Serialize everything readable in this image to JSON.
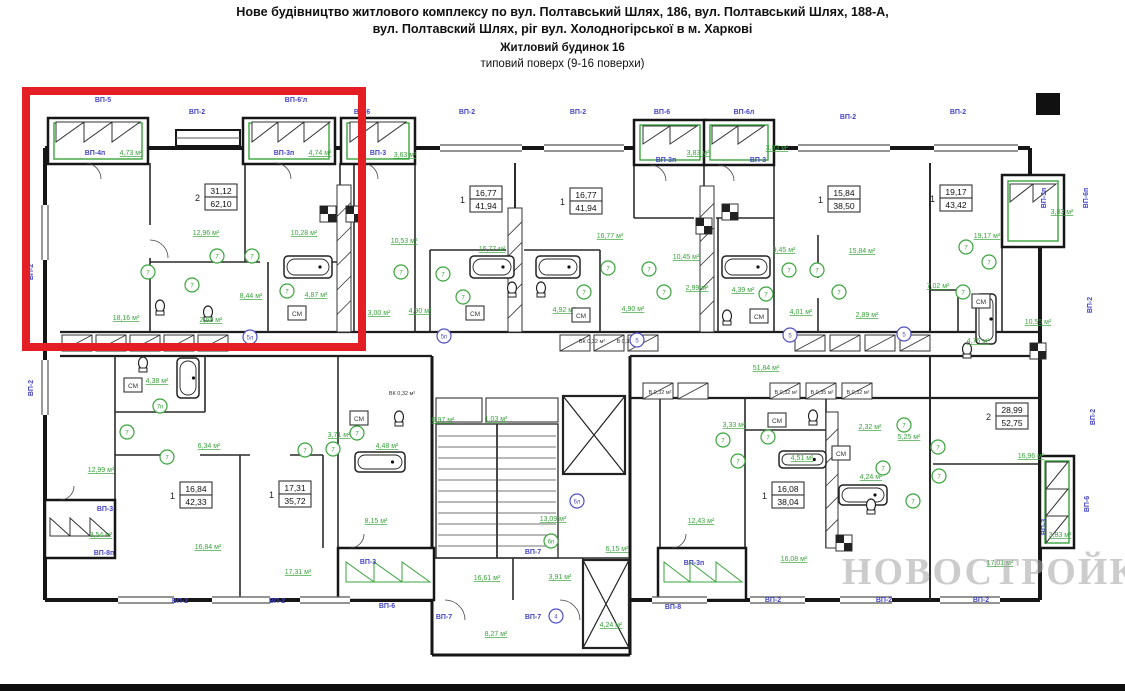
{
  "title": {
    "line1": "Нове будівництво житлового комплексу по вул. Полтавський Шлях, 186, вул. Полтавський Шлях, 188-А,",
    "line2": "вул. Полтавский Шлях, ріг вул. Холодногірської в м. Харкові",
    "line3": "Житловий будинок 16",
    "line4": "типовий поверх (9-16 поверхи)"
  },
  "watermark": "НОВОСТРОЙКИ",
  "colors": {
    "wall": "#161616",
    "green": "#3aa43c",
    "blue": "#4545c5",
    "purple": "#5050c0",
    "red": "#e31e24",
    "watermark": "#aaaaaa"
  },
  "plan": {
    "apartments": [
      {
        "num": "2",
        "upper": "31,12",
        "lower": "62,10",
        "x": 205,
        "y": 184
      },
      {
        "num": "1",
        "upper": "16,77",
        "lower": "41,94",
        "x": 470,
        "y": 186
      },
      {
        "num": "1",
        "upper": "16,77",
        "lower": "41,94",
        "x": 570,
        "y": 188
      },
      {
        "num": "1",
        "upper": "15,84",
        "lower": "38,50",
        "x": 828,
        "y": 186
      },
      {
        "num": "1",
        "upper": "19,17",
        "lower": "43,42",
        "x": 940,
        "y": 185
      },
      {
        "num": "1",
        "upper": "16,84",
        "lower": "42,33",
        "x": 180,
        "y": 482
      },
      {
        "num": "1",
        "upper": "17,31",
        "lower": "35,72",
        "x": 279,
        "y": 481
      },
      {
        "num": "1",
        "upper": "16,08",
        "lower": "38,04",
        "x": 772,
        "y": 482
      },
      {
        "num": "2",
        "upper": "28,99",
        "lower": "52,75",
        "x": 996,
        "y": 403
      }
    ],
    "vp_labels": [
      {
        "t": "ВП-5",
        "x": 103,
        "y": 102
      },
      {
        "t": "ВП-2",
        "x": 197,
        "y": 114
      },
      {
        "t": "ВП-6'л",
        "x": 296,
        "y": 102
      },
      {
        "t": "ВП-6",
        "x": 362,
        "y": 114
      },
      {
        "t": "ВП-2",
        "x": 467,
        "y": 114
      },
      {
        "t": "ВП-2",
        "x": 578,
        "y": 114
      },
      {
        "t": "ВП-6",
        "x": 662,
        "y": 114
      },
      {
        "t": "ВП-6л",
        "x": 744,
        "y": 114
      },
      {
        "t": "ВП-2",
        "x": 848,
        "y": 119
      },
      {
        "t": "ВП-2",
        "x": 958,
        "y": 114
      },
      {
        "t": "ВП-4п",
        "x": 95,
        "y": 155
      },
      {
        "t": "ВП-3п",
        "x": 284,
        "y": 155
      },
      {
        "t": "ВП-3",
        "x": 378,
        "y": 155
      },
      {
        "t": "ВП-3п",
        "x": 666,
        "y": 162
      },
      {
        "t": "ВП-3",
        "x": 758,
        "y": 162
      },
      {
        "t": "ВП-2",
        "x": 33,
        "y": 272,
        "rot": -90
      },
      {
        "t": "ВП-2",
        "x": 33,
        "y": 388,
        "rot": -90
      },
      {
        "t": "ВП-3п",
        "x": 1046,
        "y": 198,
        "rot": -90
      },
      {
        "t": "ВП-6п",
        "x": 1088,
        "y": 198,
        "rot": -90
      },
      {
        "t": "ВП-2",
        "x": 1092,
        "y": 305,
        "rot": -90
      },
      {
        "t": "ВП-2",
        "x": 1095,
        "y": 417,
        "rot": -90
      },
      {
        "t": "ВП-3",
        "x": 1046,
        "y": 527,
        "rot": -90
      },
      {
        "t": "ВП-6",
        "x": 1089,
        "y": 504,
        "rot": -90
      },
      {
        "t": "ВП-3",
        "x": 105,
        "y": 511
      },
      {
        "t": "ВП-8п",
        "x": 104,
        "y": 555
      },
      {
        "t": "ВП-2",
        "x": 180,
        "y": 603
      },
      {
        "t": "ВП-2",
        "x": 277,
        "y": 603
      },
      {
        "t": "ВП-3",
        "x": 368,
        "y": 564
      },
      {
        "t": "ВП-6",
        "x": 387,
        "y": 608
      },
      {
        "t": "ВП-7",
        "x": 533,
        "y": 554
      },
      {
        "t": "ВП-7",
        "x": 444,
        "y": 619
      },
      {
        "t": "ВП-7",
        "x": 533,
        "y": 619
      },
      {
        "t": "ВП-3п",
        "x": 694,
        "y": 565
      },
      {
        "t": "ВП-8",
        "x": 673,
        "y": 609
      },
      {
        "t": "ВП-2",
        "x": 773,
        "y": 602
      },
      {
        "t": "ВП-2",
        "x": 884,
        "y": 602
      },
      {
        "t": "ВП-2",
        "x": 981,
        "y": 602
      }
    ],
    "area_labels": [
      {
        "t": "4,73 м²",
        "x": 131,
        "y": 155
      },
      {
        "t": "4,74 м²",
        "x": 320,
        "y": 155
      },
      {
        "t": "3,63 м²",
        "x": 405,
        "y": 157
      },
      {
        "t": "3,83 м²",
        "x": 698,
        "y": 155
      },
      {
        "t": "3,83 м²",
        "x": 777,
        "y": 150
      },
      {
        "t": "3,83 м²",
        "x": 1062,
        "y": 214
      },
      {
        "t": "12,96 м²",
        "x": 206,
        "y": 235
      },
      {
        "t": "10,28 м²",
        "x": 304,
        "y": 235
      },
      {
        "t": "8,44 м²",
        "x": 251,
        "y": 298
      },
      {
        "t": "4,87 м²",
        "x": 316,
        "y": 297
      },
      {
        "t": "18,16 м²",
        "x": 126,
        "y": 320
      },
      {
        "t": "2,65 м²",
        "x": 211,
        "y": 322
      },
      {
        "t": "10,53 м²",
        "x": 404,
        "y": 243
      },
      {
        "t": "16,77 м²",
        "x": 492,
        "y": 251
      },
      {
        "t": "16,77 м²",
        "x": 610,
        "y": 238
      },
      {
        "t": "3,00 м²",
        "x": 379,
        "y": 315
      },
      {
        "t": "4,90 м²",
        "x": 420,
        "y": 313
      },
      {
        "t": "4,92 м²",
        "x": 564,
        "y": 312
      },
      {
        "t": "4,90 м²",
        "x": 633,
        "y": 311
      },
      {
        "t": "10,45 м²",
        "x": 686,
        "y": 259
      },
      {
        "t": "9,45 м²",
        "x": 784,
        "y": 252
      },
      {
        "t": "15,84 м²",
        "x": 862,
        "y": 253
      },
      {
        "t": "2,99 м²",
        "x": 697,
        "y": 290
      },
      {
        "t": "4,39 м²",
        "x": 743,
        "y": 292
      },
      {
        "t": "4,01 м²",
        "x": 801,
        "y": 314
      },
      {
        "t": "2,89 м²",
        "x": 867,
        "y": 317
      },
      {
        "t": "19,17 м²",
        "x": 987,
        "y": 238
      },
      {
        "t": "7,02 м²",
        "x": 938,
        "y": 288
      },
      {
        "t": "10,55 м²",
        "x": 1038,
        "y": 324
      },
      {
        "t": "4,76 м²",
        "x": 978,
        "y": 343
      },
      {
        "t": "51,84 м²",
        "x": 766,
        "y": 370
      },
      {
        "t": "4,38 м²",
        "x": 157,
        "y": 383
      },
      {
        "t": "12,99 м²",
        "x": 101,
        "y": 472
      },
      {
        "t": "3,54 м²",
        "x": 101,
        "y": 537
      },
      {
        "t": "6,34 м²",
        "x": 209,
        "y": 448
      },
      {
        "t": "16,84 м²",
        "x": 208,
        "y": 549
      },
      {
        "t": "17,31 м²",
        "x": 298,
        "y": 574
      },
      {
        "t": "3,71 м²",
        "x": 339,
        "y": 437
      },
      {
        "t": "4,48 м²",
        "x": 387,
        "y": 448
      },
      {
        "t": "8,15 м²",
        "x": 376,
        "y": 523
      },
      {
        "t": "0,97 м²",
        "x": 443,
        "y": 422
      },
      {
        "t": "1,03 м²",
        "x": 496,
        "y": 421
      },
      {
        "t": "16,61 м²",
        "x": 487,
        "y": 580
      },
      {
        "t": "3,91 м²",
        "x": 560,
        "y": 579
      },
      {
        "t": "13,09 м²",
        "x": 553,
        "y": 521
      },
      {
        "t": "6,15 м²",
        "x": 617,
        "y": 551
      },
      {
        "t": "8,27 м²",
        "x": 496,
        "y": 636
      },
      {
        "t": "4,24 м²",
        "x": 611,
        "y": 627
      },
      {
        "t": "12,43 м²",
        "x": 701,
        "y": 523
      },
      {
        "t": "16,08 м²",
        "x": 794,
        "y": 561
      },
      {
        "t": "3,33 м²",
        "x": 734,
        "y": 427
      },
      {
        "t": "2,32 м²",
        "x": 870,
        "y": 429
      },
      {
        "t": "4,51 м²",
        "x": 802,
        "y": 460
      },
      {
        "t": "4,24 м²",
        "x": 871,
        "y": 479
      },
      {
        "t": "5,25 м²",
        "x": 909,
        "y": 439
      },
      {
        "t": "16,96 м²",
        "x": 1031,
        "y": 458
      },
      {
        "t": "17,01 м²",
        "x": 1000,
        "y": 565
      },
      {
        "t": "3,83 м²",
        "x": 1060,
        "y": 537
      }
    ],
    "cm_label": "СМ",
    "cm_boxes": [
      {
        "x": 288,
        "y": 306
      },
      {
        "x": 466,
        "y": 306
      },
      {
        "x": 572,
        "y": 308
      },
      {
        "x": 750,
        "y": 309
      },
      {
        "x": 972,
        "y": 294
      },
      {
        "x": 124,
        "y": 378
      },
      {
        "x": 350,
        "y": 411
      },
      {
        "x": 768,
        "y": 413
      },
      {
        "x": 832,
        "y": 446
      }
    ],
    "duct_labels": [
      {
        "t": "ВК 0,32 м²",
        "x": 402,
        "y": 395
      },
      {
        "t": "ВК 0,32 м²",
        "x": 592,
        "y": 343
      },
      {
        "t": "В 0,32 м²",
        "x": 628,
        "y": 343
      },
      {
        "t": "В 0,32 м²",
        "x": 660,
        "y": 394
      },
      {
        "t": "В 0,32 м²",
        "x": 786,
        "y": 394
      },
      {
        "t": "В 0,35 м²",
        "x": 822,
        "y": 394
      },
      {
        "t": "В 0,32 м²",
        "x": 858,
        "y": 394
      }
    ],
    "markers_green": [
      {
        "t": "7",
        "x": 217,
        "y": 256
      },
      {
        "t": "7",
        "x": 252,
        "y": 256
      },
      {
        "t": "7",
        "x": 148,
        "y": 272
      },
      {
        "t": "7",
        "x": 192,
        "y": 285
      },
      {
        "t": "7",
        "x": 287,
        "y": 291
      },
      {
        "t": "7",
        "x": 401,
        "y": 272
      },
      {
        "t": "7",
        "x": 443,
        "y": 274
      },
      {
        "t": "7",
        "x": 463,
        "y": 297
      },
      {
        "t": "7",
        "x": 584,
        "y": 292
      },
      {
        "t": "7",
        "x": 608,
        "y": 268
      },
      {
        "t": "7",
        "x": 649,
        "y": 269
      },
      {
        "t": "7",
        "x": 664,
        "y": 292
      },
      {
        "t": "7",
        "x": 766,
        "y": 294
      },
      {
        "t": "7",
        "x": 789,
        "y": 270
      },
      {
        "t": "7",
        "x": 817,
        "y": 270
      },
      {
        "t": "7",
        "x": 839,
        "y": 292
      },
      {
        "t": "7",
        "x": 966,
        "y": 247
      },
      {
        "t": "7",
        "x": 989,
        "y": 262
      },
      {
        "t": "7",
        "x": 963,
        "y": 292
      },
      {
        "t": "7",
        "x": 127,
        "y": 432
      },
      {
        "t": "7п",
        "x": 160,
        "y": 406
      },
      {
        "t": "7",
        "x": 167,
        "y": 457
      },
      {
        "t": "7",
        "x": 305,
        "y": 450
      },
      {
        "t": "7",
        "x": 333,
        "y": 449
      },
      {
        "t": "7",
        "x": 357,
        "y": 433
      },
      {
        "t": "7",
        "x": 723,
        "y": 440
      },
      {
        "t": "7",
        "x": 768,
        "y": 437
      },
      {
        "t": "7",
        "x": 738,
        "y": 461
      },
      {
        "t": "7",
        "x": 883,
        "y": 468
      },
      {
        "t": "7",
        "x": 904,
        "y": 425
      },
      {
        "t": "7",
        "x": 938,
        "y": 447
      },
      {
        "t": "7",
        "x": 939,
        "y": 476
      },
      {
        "t": "7",
        "x": 913,
        "y": 501
      },
      {
        "t": "6п",
        "x": 551,
        "y": 541
      }
    ],
    "markers_purple": [
      {
        "t": "5л",
        "x": 250,
        "y": 337
      },
      {
        "t": "5п",
        "x": 444,
        "y": 336
      },
      {
        "t": "5",
        "x": 637,
        "y": 340
      },
      {
        "t": "5",
        "x": 790,
        "y": 335
      },
      {
        "t": "5",
        "x": 904,
        "y": 334
      },
      {
        "t": "4",
        "x": 556,
        "y": 616
      },
      {
        "t": "6л",
        "x": 577,
        "y": 501
      }
    ]
  }
}
